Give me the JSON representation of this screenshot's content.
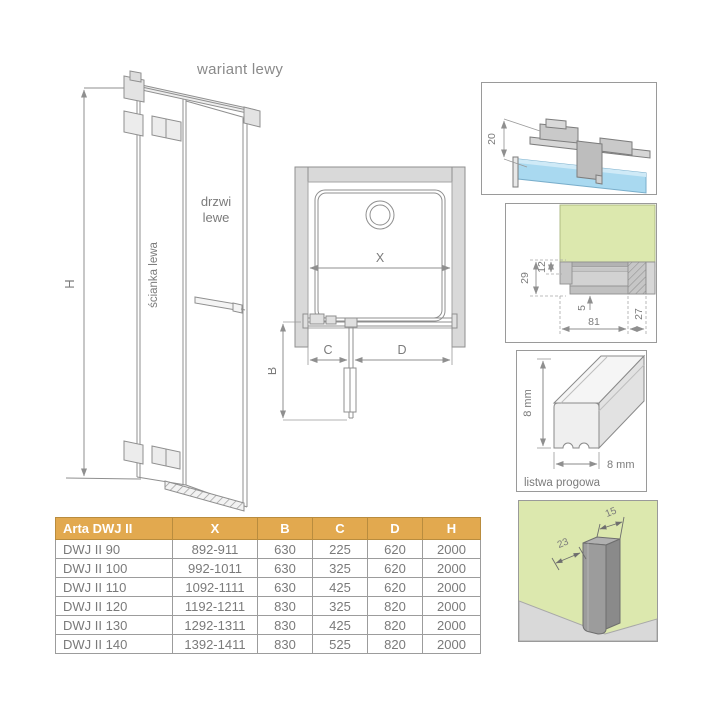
{
  "title": "wariant lewy",
  "elevation": {
    "dim_h": "H",
    "wall_label": "ścianka lewa",
    "door_label_line1": "drzwi",
    "door_label_line2": "lewe"
  },
  "plan": {
    "dim_x": "X",
    "dim_b": "B",
    "dim_c": "C",
    "dim_d": "D"
  },
  "details": {
    "top_bracket": {
      "dim_20": "20"
    },
    "section": {
      "dim_29": "29",
      "dim_12": "12",
      "dim_5": "5",
      "dim_81": "81",
      "dim_27": "27"
    },
    "threshold": {
      "dim_height": "8 mm",
      "dim_width": "8 mm",
      "caption": "listwa progowa"
    },
    "wall_profile": {
      "dim_23": "23",
      "dim_15": "15"
    }
  },
  "colors": {
    "table_header": "#e2a94f",
    "glass_blue": "#a9d9f0",
    "panel_green": "#dce8ae",
    "wall_gray": "#d9d9d9",
    "line_gray": "#8f8f8f"
  },
  "table": {
    "headers": [
      "Arta DWJ II",
      "X",
      "B",
      "C",
      "D",
      "H"
    ],
    "rows": [
      [
        "DWJ II 90",
        "892-911",
        "630",
        "225",
        "620",
        "2000"
      ],
      [
        "DWJ II 100",
        "992-1011",
        "630",
        "325",
        "620",
        "2000"
      ],
      [
        "DWJ II 110",
        "1092-1111",
        "630",
        "425",
        "620",
        "2000"
      ],
      [
        "DWJ II 120",
        "1192-1211",
        "830",
        "325",
        "820",
        "2000"
      ],
      [
        "DWJ II 130",
        "1292-1311",
        "830",
        "425",
        "820",
        "2000"
      ],
      [
        "DWJ II 140",
        "1392-1411",
        "830",
        "525",
        "820",
        "2000"
      ]
    ]
  }
}
